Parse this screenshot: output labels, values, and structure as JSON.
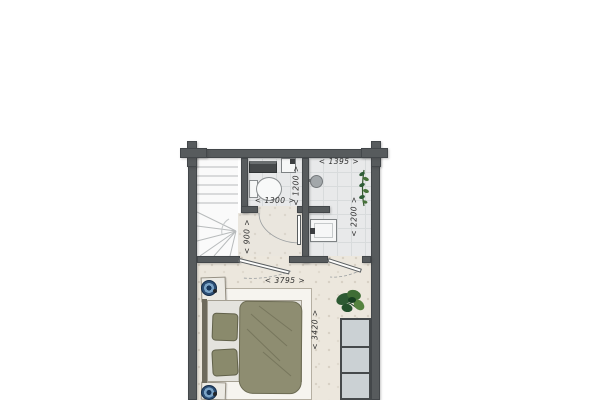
{
  "floorplan": {
    "dimension_labels": [
      {
        "id": "bathroom-width",
        "text": "< 1395 >",
        "orientation": "horizontal"
      },
      {
        "id": "toilet-depth",
        "text": "< 1200 >",
        "orientation": "vertical"
      },
      {
        "id": "toilet-width",
        "text": "< 1300 >",
        "orientation": "horizontal"
      },
      {
        "id": "bathroom-depth",
        "text": "< 2200 >",
        "orientation": "vertical"
      },
      {
        "id": "landing-depth",
        "text": "< 900 >",
        "orientation": "vertical"
      },
      {
        "id": "bedroom-width",
        "text": "< 3795 >",
        "orientation": "horizontal"
      },
      {
        "id": "bedroom-depth",
        "text": "< 3420 >",
        "orientation": "vertical"
      }
    ],
    "fixtures": [
      "staircase",
      "toilet",
      "hand-basin",
      "shelf",
      "washbasin",
      "shower-head",
      "bed",
      "pillow",
      "duvet",
      "nightstand",
      "table-lamp",
      "rug",
      "wardrobe",
      "plant",
      "door"
    ],
    "colors": {
      "wall": "#575b5d",
      "tile_floor": "#e8e9ea",
      "wood_floor": "#ece7dd",
      "rug": "#f6f4ef",
      "duvet": "#8e8d71",
      "pillow": "#8a8a6c",
      "lamp_accent": "#2d4f76",
      "plant": "#2e5c36",
      "wardrobe": "#cbd1d4"
    }
  }
}
